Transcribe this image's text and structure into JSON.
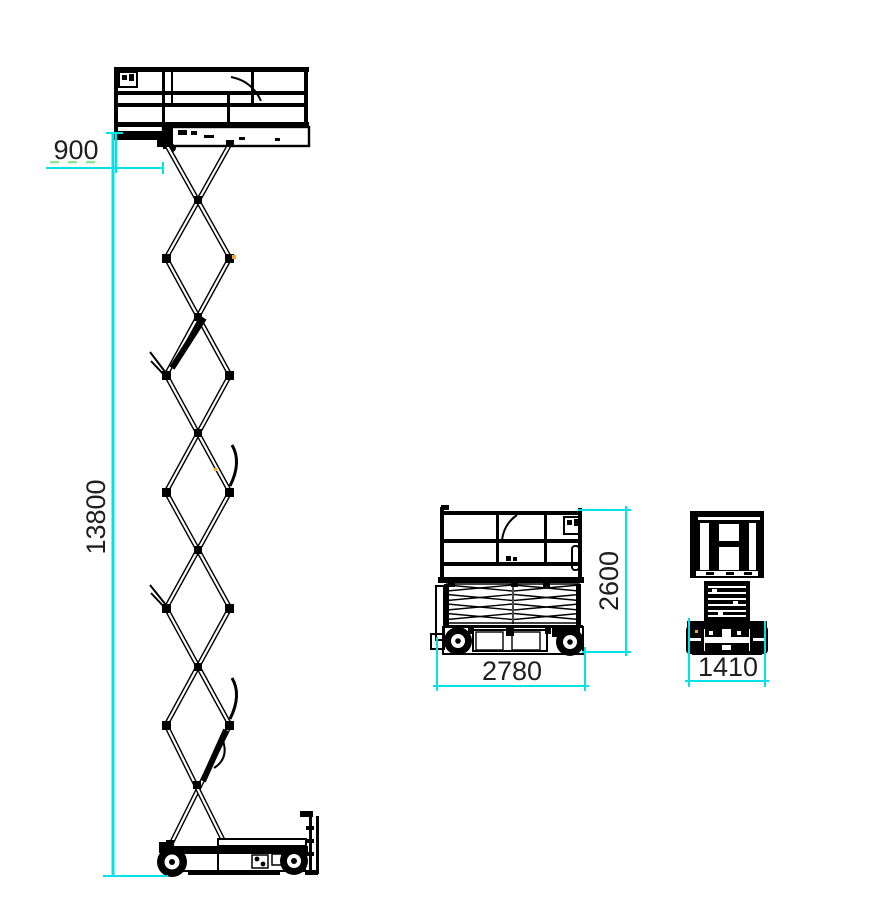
{
  "page": {
    "background": "#ffffff",
    "description": "Technical dimensional line drawing of a scissor lift: elevated side view, stowed side view and stowed front view with dimension callouts"
  },
  "colors": {
    "drawing_line": "#000000",
    "dimension_line": "#00e2e5",
    "dimension_text": "#1f1f1f",
    "accent_dash_green": "#8ee59a",
    "joint_accent_orange": "#f5a623"
  },
  "views": {
    "elevated_side": {
      "name": "side-view-platform-elevated",
      "dimensions": {
        "platform_extension_mm": "900",
        "working_height_mm": "13800"
      }
    },
    "stowed_side": {
      "name": "side-view-stowed",
      "dimensions": {
        "overall_length_mm": "2780",
        "stowed_height_mm": "2600"
      }
    },
    "stowed_front": {
      "name": "front-view-stowed",
      "dimensions": {
        "overall_width_mm": "1410"
      }
    }
  }
}
